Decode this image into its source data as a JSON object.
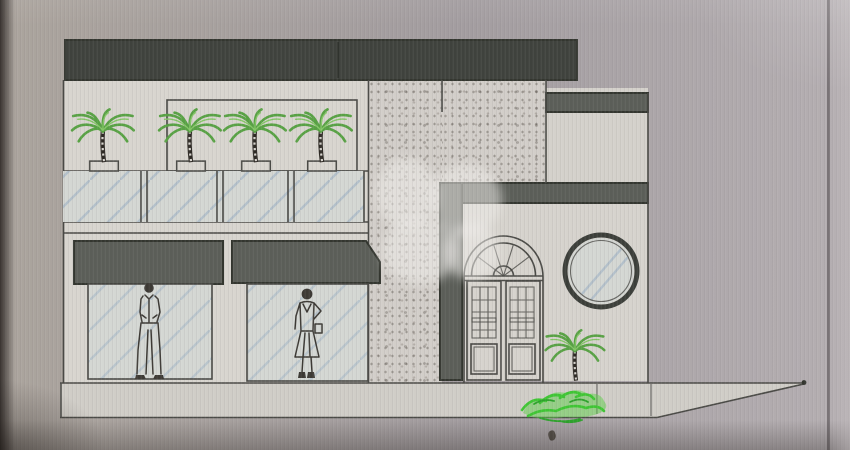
{
  "meta": {
    "kind": "architectural-front-elevation-drawing",
    "subject": "two-storey storefront facade photographed from a computer screen",
    "text_content": "none"
  },
  "scene": {
    "parapet_band_count": 1,
    "upper_level": {
      "palm_planters": 4,
      "glass_panels": 4,
      "recessed_wall_panel": 1
    },
    "lower_level": {
      "signboards": 2,
      "display_windows": 2,
      "figures": [
        "standing-man",
        "standing-woman"
      ]
    },
    "entrance": {
      "door_type": "double-leaf arched door with fanlight",
      "door_leaves": 2,
      "round_window_count": 1
    },
    "middle_pier": "stippled stone pillar",
    "landscape": {
      "ground_palm_count": 1,
      "shrub_count": 1
    },
    "watermark": "translucent white blob logo over centre"
  },
  "colors": {
    "background": "#a39da0",
    "background_left": "#aba49d",
    "background_right": "#b5afb2",
    "paper": "#d8d5cf",
    "paper_dim": "#d0cdc7",
    "texture_base": "#d2cec9",
    "band_dark": "#3f423d",
    "band_mid": "#5b5e58",
    "line": "#4a4a46",
    "line_dark": "#33362f",
    "glass_tint": "#d4d7d3",
    "glass_line": "#9db1c4",
    "palm_green": "#58a244",
    "palm_green_light": "#84c766",
    "trunk": "#2e2a25",
    "shrub_green": "#3fc634",
    "shrub_green_dark": "#2da32b",
    "figure": "#3d3a35",
    "watermark": "#efedea",
    "speck": "#4a443d"
  }
}
